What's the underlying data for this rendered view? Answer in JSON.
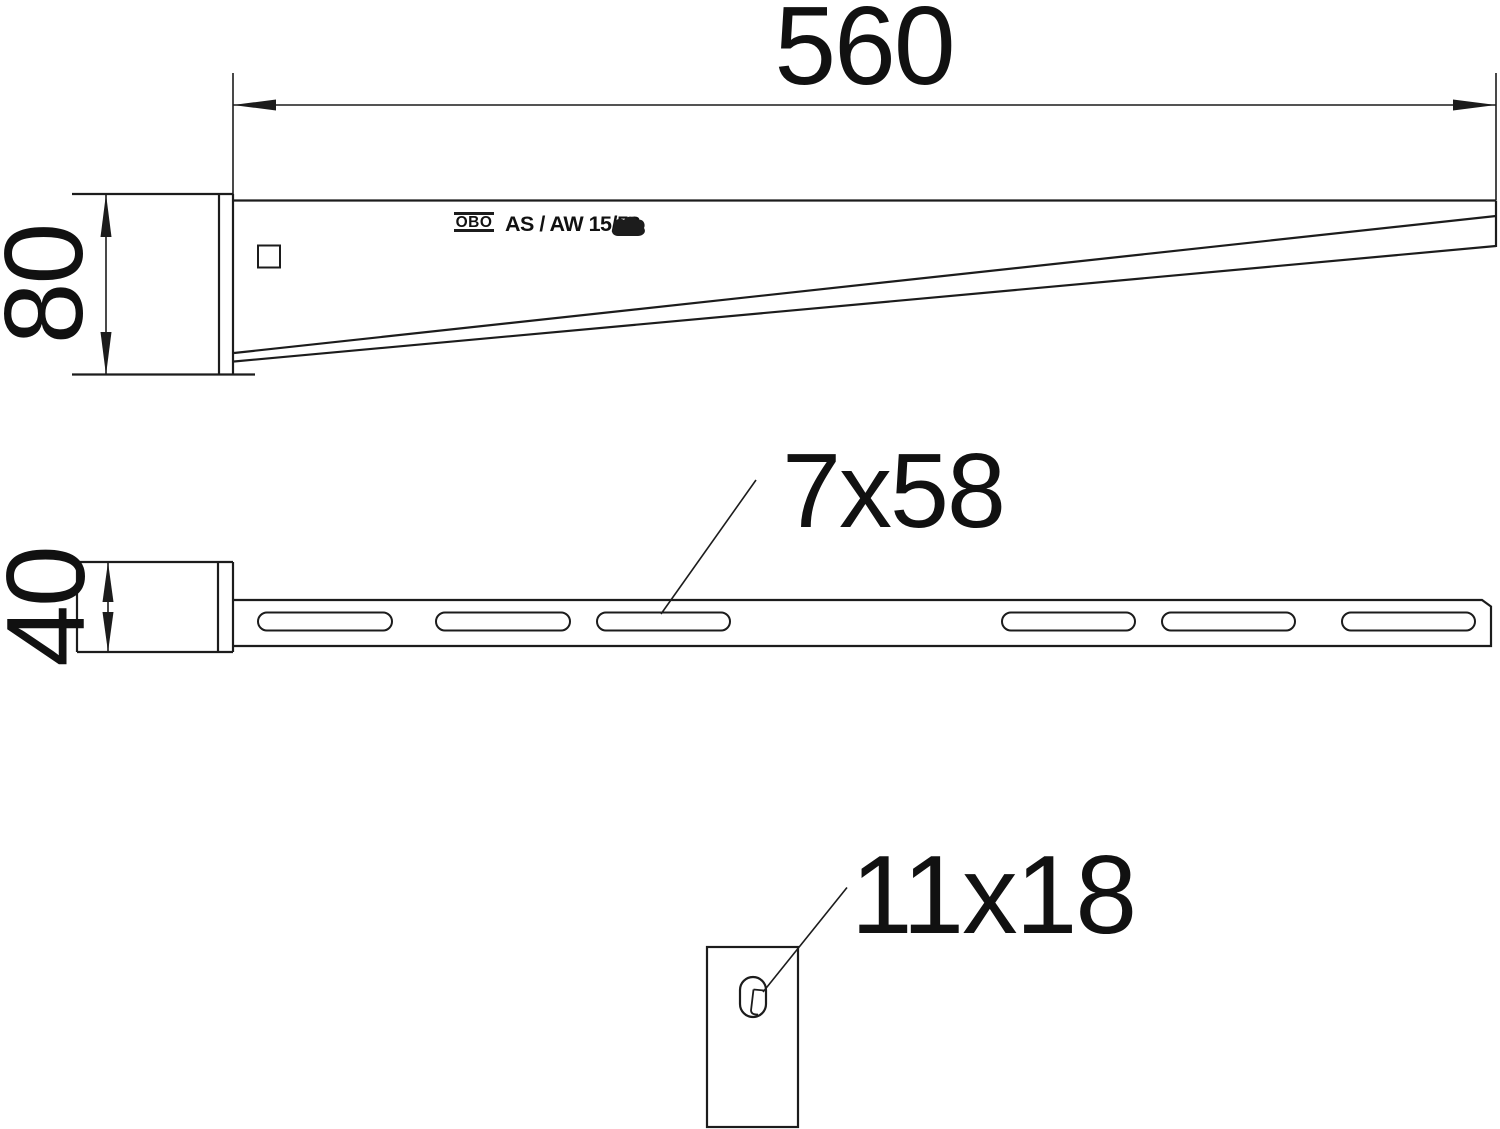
{
  "labels": {
    "length": "560",
    "height": "80",
    "width": "40",
    "slot_size": "7x58",
    "hole_size": "11x18"
  },
  "marking": {
    "logo": "OBO",
    "text": "AS / AW 15/58"
  },
  "colors": {
    "line": "#1c1c1c",
    "text": "#111111",
    "background": "#ffffff"
  }
}
